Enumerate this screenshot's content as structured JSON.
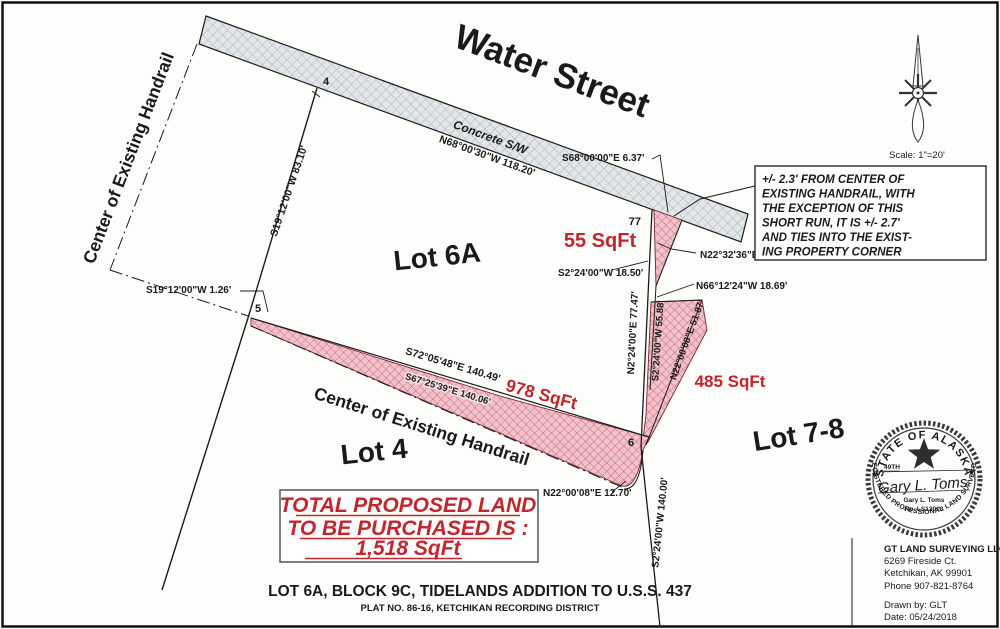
{
  "street": {
    "name": "Water Street",
    "sidewalk": "Concrete S/W"
  },
  "lots": {
    "lot6a": "Lot 6A",
    "lot4": "Lot 4",
    "lot78": "Lot 7-8"
  },
  "areas": {
    "a55": "55 SqFt",
    "a485": "485 SqFt",
    "a978": "978 SqFt",
    "total_lines": [
      "TOTAL PROPOSED LAND",
      "TO BE PURCHASED IS :",
      "1,518 SqFt"
    ]
  },
  "handrail": {
    "label": "Center of Existing Handrail"
  },
  "points": {
    "p4": "4",
    "p5": "5",
    "p6": "6",
    "p77": "77"
  },
  "bearings": {
    "sidewalk": "N68°00'30\"W 118.20'",
    "sidewalk_end": "S68°00'00\"E 6.37'",
    "west_line": "S19°12'00\"W 83.10'",
    "west_jog": "S19°12'00\"W 1.26'",
    "south_top": "S72°05'48\"E 140.49'",
    "south_rail": "S67°25'39\"E 140.06'",
    "east_outer": "N2°24'00\"E 77.47'",
    "east_inner": "S2°24'00\"W 55.88'",
    "east_diag": "N22°00'08\"E 51.87'",
    "tie_ne": "N22°32'36\"E 17.43'",
    "tie_sw": "S2°24'00\"W 18.50'",
    "tie_nw": "N66°12'24\"W 18.69'",
    "hook": "N22°00'08\"E 12.70'",
    "south_line": "S2°24'00\"W 140.00'"
  },
  "note_box": {
    "lines": [
      "+/- 2.3'  FROM CENTER OF",
      "EXISTING HANDRAIL, WITH",
      "THE EXCEPTION OF THIS",
      "SHORT RUN, IT IS +/- 2.7'",
      "AND TIES INTO THE EXIST-",
      "ING PROPERTY CORNER"
    ]
  },
  "compass": {
    "scale": "Scale:  1\"=20'"
  },
  "seal": {
    "arc_top": "STATE OF ALASKA",
    "arc_bottom": "REGISTERED PROFESSIONAL LAND SURVEYOR",
    "forty_ninth": "49TH",
    "star": "★",
    "signature": "Gary L. Toms",
    "name": "Gary L. Toms",
    "license": "No. LS13013"
  },
  "surveyor": {
    "company": "GT LAND SURVEYING LLC",
    "address1": "6269 Fireside Ct.",
    "address2": "Ketchikan, AK 99901",
    "phone": "Phone 907-821-8764",
    "drawn_by": "Drawn by:  GLT",
    "date": "Date:  05/24/2018"
  },
  "footer": {
    "title": "LOT 6A, BLOCK 9C, TIDELANDS ADDITION TO U.S.S. 437",
    "subtitle": "PLAT NO. 86-16,  KETCHIKAN RECORDING DISTRICT"
  },
  "colors": {
    "highlight": "#c1262d",
    "sidewalk": "#e2e6e8"
  }
}
